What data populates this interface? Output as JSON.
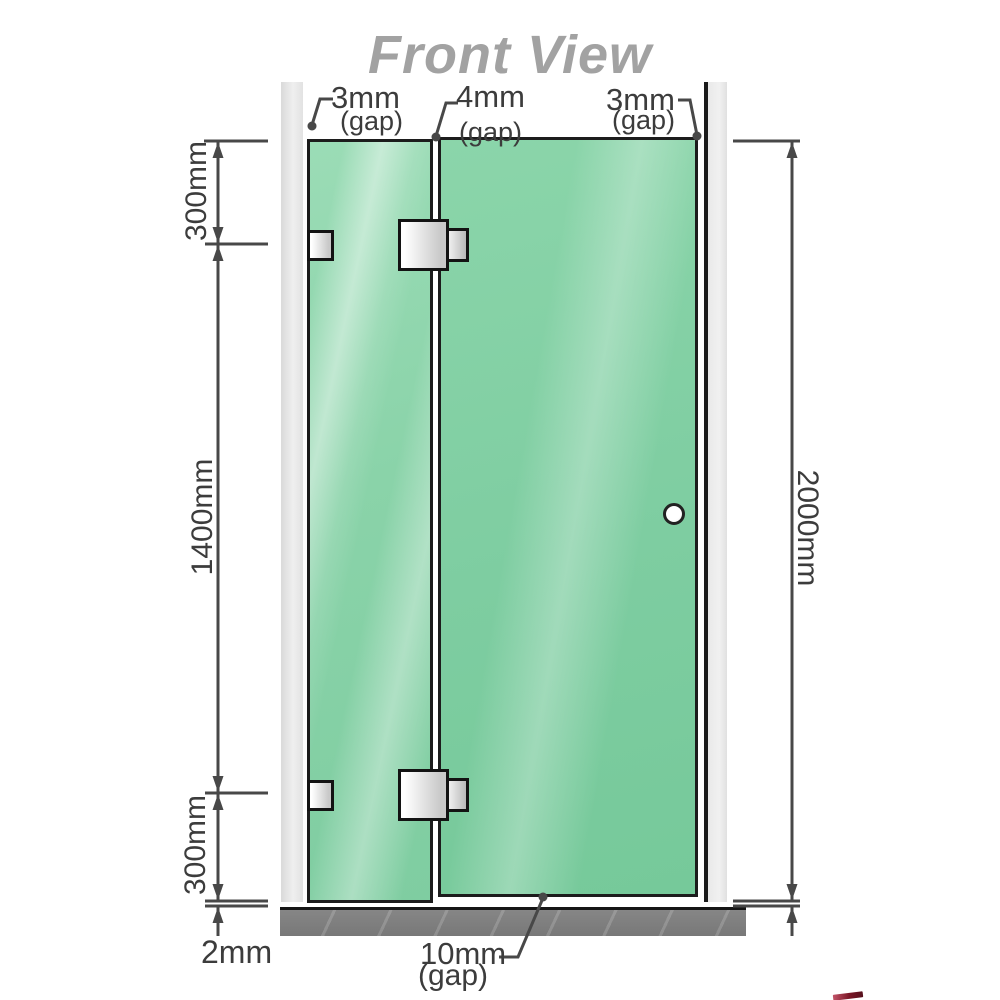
{
  "title": "Front View",
  "dimensions": {
    "gap_top_left": "3mm",
    "gap_top_left_unit": "(gap)",
    "gap_top_middle": "4mm",
    "gap_top_middle_unit": "(gap)",
    "gap_top_right": "3mm",
    "gap_top_right_unit": "(gap)",
    "left_top_segment": "300mm",
    "left_middle_segment": "1400mm",
    "left_bottom_segment": "300mm",
    "right_total_height": "2000mm",
    "floor_clearance": "2mm",
    "bottom_gap": "10mm",
    "bottom_gap_unit": "(gap)"
  },
  "components": {
    "left_wall": "wall",
    "right_wall": "wall",
    "fixed_panel": "fixed glass panel",
    "door_panel": "hinged glass door panel",
    "door_knob": "round door knob",
    "wall_brackets": "2 wall-mount glass clamps",
    "hinges": "2 glass-to-glass hinges",
    "floor": "hatched floor strip"
  },
  "colors": {
    "glass_fixed": "#8fd5ac",
    "glass_door": "#7ecda1",
    "wall": "#e8e8e8",
    "floor": "#7c7c7c",
    "line": "#484848",
    "title": "#a2a2a2",
    "hardware": "#d9d9d9",
    "outline": "#1c1c1c"
  }
}
